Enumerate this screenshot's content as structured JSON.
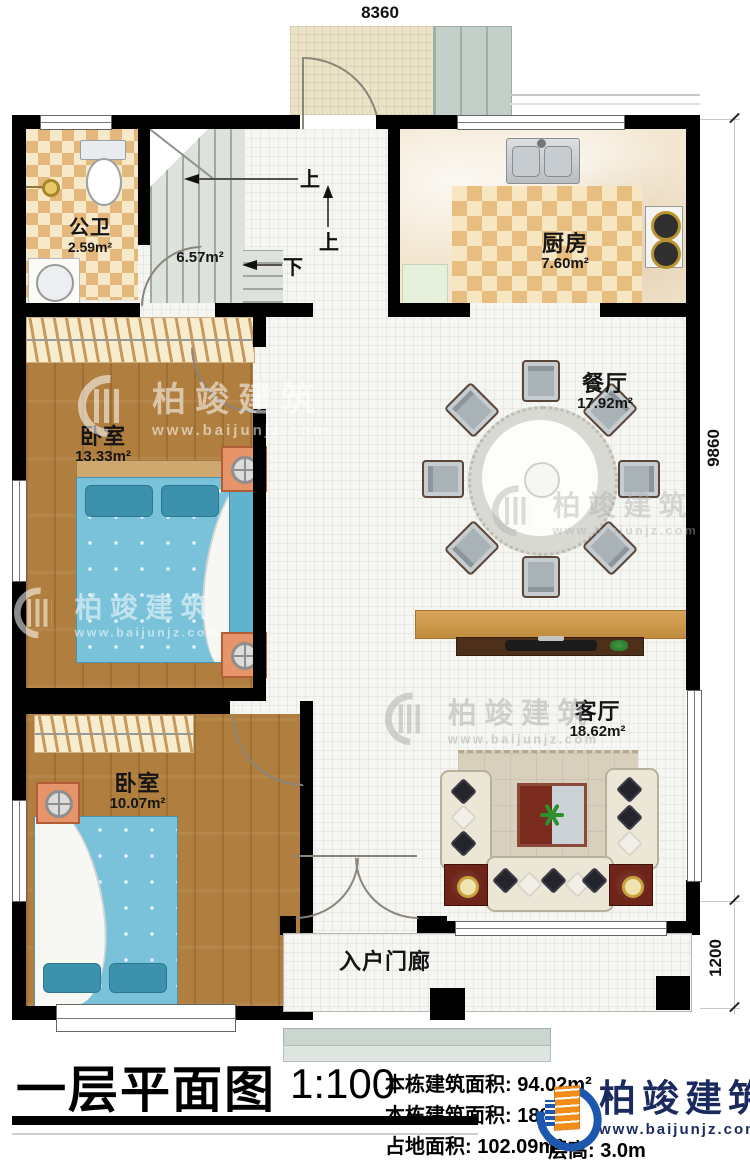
{
  "dimensions": {
    "top": "8360",
    "right_main": "9860",
    "right_porch": "1200"
  },
  "stairs": {
    "area": "6.57m²",
    "up_a": "上",
    "up_b": "上",
    "down": "下"
  },
  "rooms": {
    "bathroom": {
      "name": "公卫",
      "area": "2.59m²"
    },
    "kitchen": {
      "name": "厨房",
      "area": "7.60m²"
    },
    "dining": {
      "name": "餐厅",
      "area": "17.92m²"
    },
    "bedroom_upper": {
      "name": "卧室",
      "area": "13.33m²"
    },
    "bedroom_lower": {
      "name": "卧室",
      "area": "10.07m²"
    },
    "living": {
      "name": "客厅",
      "area": "18.62m²"
    },
    "porch": {
      "name": "入户门廊"
    }
  },
  "title_block": {
    "title": "一层平面图",
    "scale": "1:100",
    "stat1_label": "本栋建筑面积:",
    "stat1_value": "94.02m²",
    "stat2_label": "本栋建筑面积:",
    "stat2_value": "188.",
    "stat2_sup": "²",
    "stat3_label": "占地面积:",
    "stat3_value": "102.09m²",
    "stat4_label": "层高:",
    "stat4_value": "3.0m"
  },
  "brand": {
    "name": "柏竣建筑",
    "url": "www.baijunjz.com"
  },
  "watermark": {
    "name": "柏竣建筑",
    "url": "www.baijunjz.com"
  },
  "colors": {
    "wall": "#000000",
    "brand_navy": "#1b2a5e",
    "brand_blue": "#1d57ae",
    "brand_orange": "#f08c1a"
  }
}
